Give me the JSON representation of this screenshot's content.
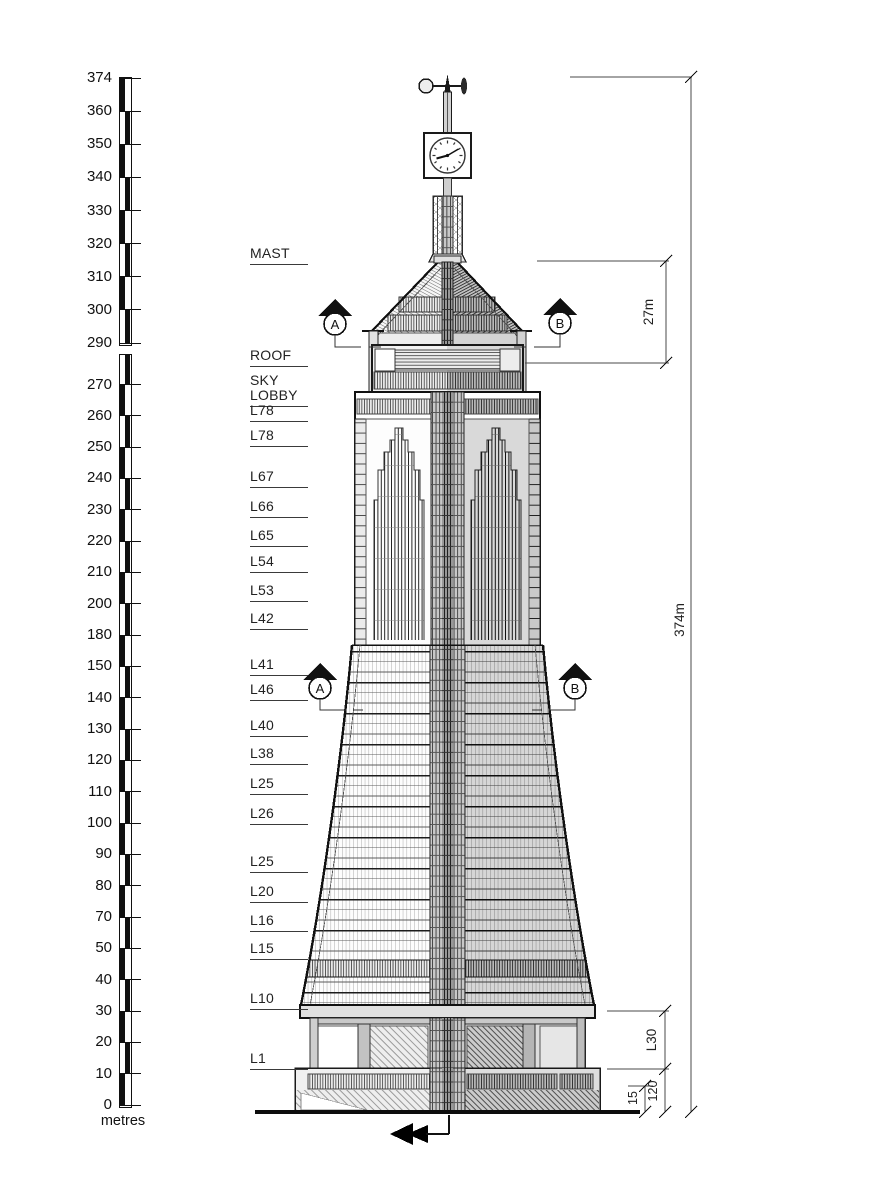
{
  "scale_bar": {
    "unit": "metres",
    "upper_labels": [
      "374",
      "360",
      "350",
      "340",
      "330",
      "320",
      "310",
      "300",
      "290"
    ],
    "lower_labels": [
      "270",
      "260",
      "250",
      "240",
      "230",
      "220",
      "210",
      "200",
      "180",
      "150",
      "140",
      "130",
      "120",
      "110",
      "100",
      "90",
      "80",
      "70",
      "50",
      "40",
      "30",
      "20",
      "10",
      "0"
    ]
  },
  "levels": [
    "MAST",
    "ROOF",
    "SKY LOBBY",
    "L78",
    "L78",
    "L67",
    "L66",
    "L65",
    "L54",
    "L53",
    "L42",
    "L41",
    "L46",
    "L40",
    "L38",
    "L25",
    "L26",
    "L25",
    "L20",
    "L16",
    "L15",
    "L10",
    "L1"
  ],
  "dimensions": {
    "overall_height": "374m",
    "crown_height": "27m",
    "lower_zone": "L30",
    "podium": "120",
    "entry": "15"
  },
  "section_markers": {
    "a": "A",
    "b": "B"
  },
  "colors": {
    "ink": "#1a1a1a",
    "shade_light": "#d8d8d8",
    "shade_dark": "#bfbfbf",
    "paper": "#ffffff"
  }
}
